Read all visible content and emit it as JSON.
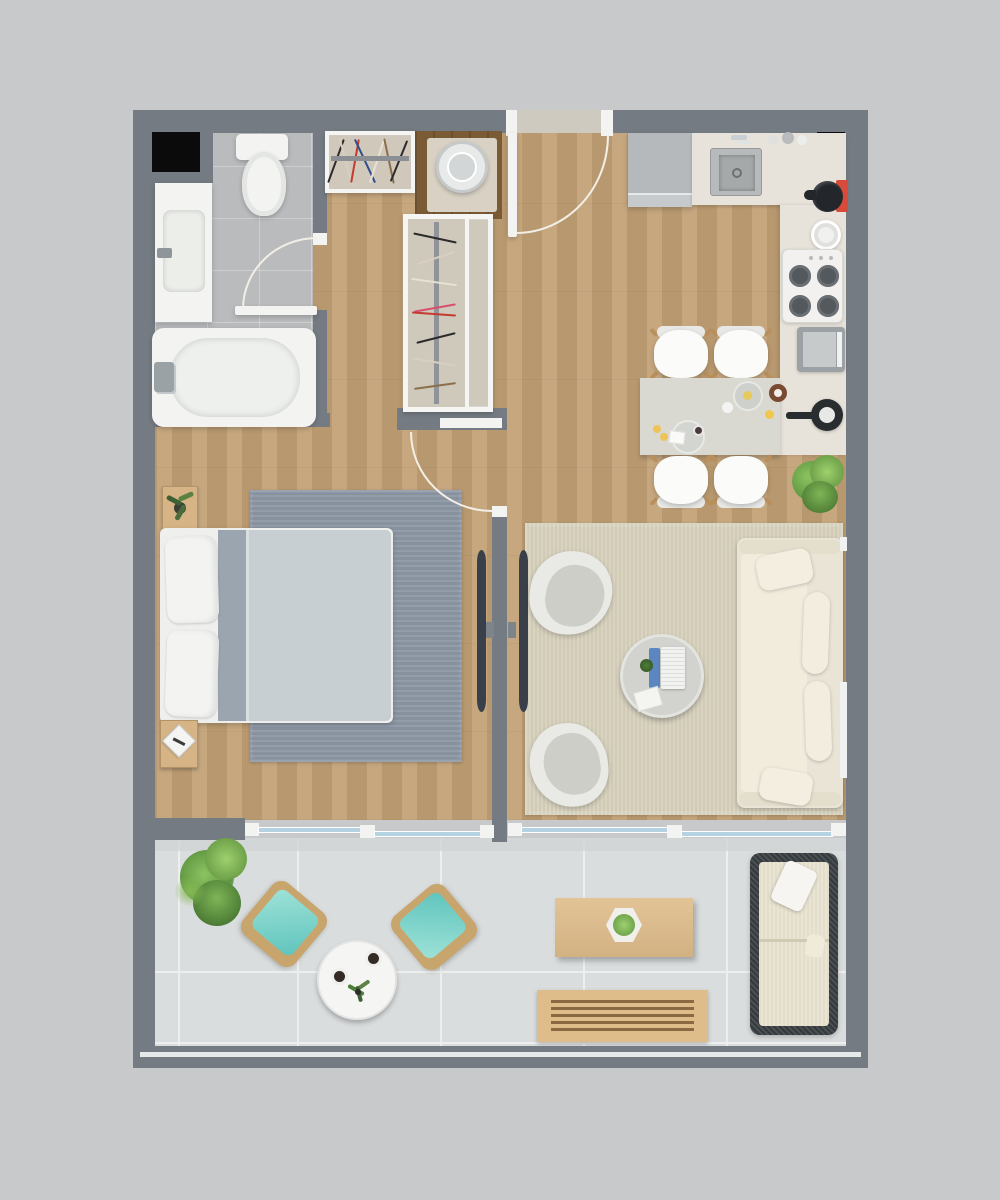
{
  "scene": {
    "type": "apartment-floor-plan-render",
    "view": "top-down",
    "style": "photorealistic-3d",
    "text_visible": "none"
  },
  "palette": {
    "bg": "#c7c9cb",
    "wall": "#747b82",
    "wallDark": "#666d74",
    "white": "#f5f5f3",
    "black": "#0b0b0c",
    "wood": "#c2a074",
    "woodDark": "#8a6a42",
    "woodNook": "#7b5a36",
    "tileBath": "#b9bbbd",
    "tileBalcony": "#dadddd",
    "grout": "#edefee",
    "track": "#cfd4d4",
    "counter": "#e7e3da",
    "tableTop": "#d9d9d1",
    "fridge": "#b5b9bb",
    "steel": "#a8abab",
    "stoveWhite": "#f2f1ef",
    "burner": "#54595d",
    "appliance": "#9ba1a4",
    "red": "#d84a39",
    "kettle": "#23262b",
    "rugBedroom": "#8d98a5",
    "duvet": "#c8cfd2",
    "blanket": "#9aa5af",
    "bedWhite": "#f3f4f2",
    "rugLiving": "#d7d1bc",
    "sofa": "#e9e4d5",
    "sofaLight": "#f1ecdc",
    "shell": "#e9e9e5",
    "cushion": "#cdcec8",
    "tableRound": "#d2d3cf",
    "laptopBlue": "#5b86c0",
    "teal": "#7ed2c6",
    "rattan": "#c9a56e",
    "outWood": "#dfbd8b",
    "outFrame": "#3d4347",
    "outCushion": "#eae4d2",
    "plant": "#6fa24a",
    "plantDark": "#3f5f35",
    "glass": "#b5d2e2",
    "railWhite": "#e6e9e8"
  },
  "rooms": [
    {
      "name": "bathroom",
      "furniture": [
        "service-shaft",
        "toilet",
        "vanity-sink",
        "bathtub",
        "swing-door"
      ]
    },
    {
      "name": "entry-hall",
      "furniture": [
        "entry-door",
        "wardrobe",
        "washing-machine",
        "tall-wardrobe"
      ]
    },
    {
      "name": "kitchen",
      "furniture": [
        "refrigerator",
        "kitchen-sink",
        "spice-jars",
        "kettle",
        "plate",
        "cooktop-4-burner",
        "oven",
        "counter-l-shape",
        "service-shaft",
        "frying-pan"
      ]
    },
    {
      "name": "dining",
      "furniture": [
        "dining-table",
        "dining-chair",
        "dining-chair",
        "dining-chair",
        "dining-chair",
        "tableware",
        "floor-plant"
      ]
    },
    {
      "name": "bedroom",
      "furniture": [
        "double-bed",
        "area-rug",
        "nightstand-plant",
        "nightstand-book",
        "wall-tv",
        "swing-door",
        "sliding-glass-door"
      ]
    },
    {
      "name": "living-room",
      "furniture": [
        "area-rug",
        "armchair",
        "armchair",
        "round-coffee-table",
        "laptop",
        "sofa",
        "wall-tv",
        "sliding-glass-door",
        "window"
      ]
    },
    {
      "name": "balcony",
      "furniture": [
        "potted-plant",
        "lounge-chair-teal",
        "lounge-chair-teal",
        "round-side-table",
        "wood-coffee-table",
        "hex-planter",
        "slatted-bench",
        "outdoor-sofa",
        "railing"
      ]
    }
  ],
  "counts": {
    "tvs": 2,
    "dining_chairs": 4,
    "balcony_chairs": 2,
    "burners": 4
  }
}
